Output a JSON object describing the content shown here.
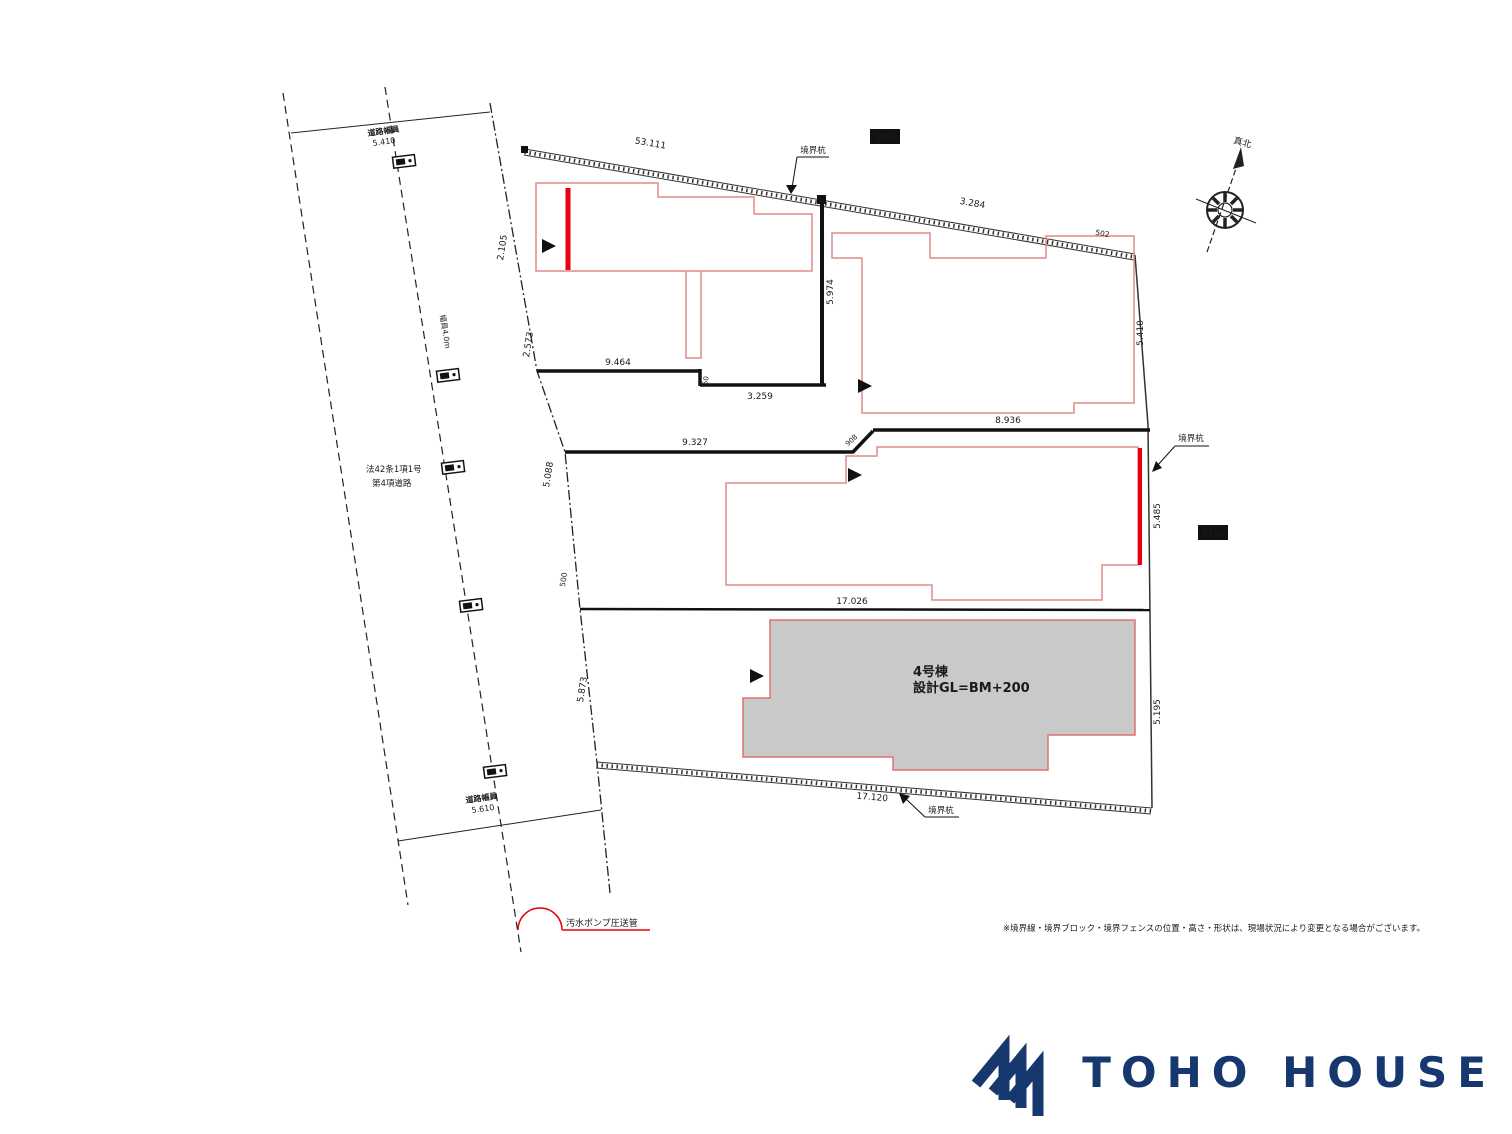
{
  "plan": {
    "north_label": "真北",
    "marker_top": "境界杭",
    "marker_right": "境界杭",
    "marker_bottom": "境界杭",
    "box_top": "B50",
    "box_right": "B110",
    "road": {
      "width_top_label": "道路幅員",
      "width_top_value": "5.410",
      "width_bottom_label": "道路幅員",
      "width_bottom_value": "5.610",
      "law_line1": "法42条1項1号",
      "law_line2": "第4項道路",
      "along_label": "幅員4.0m"
    },
    "dims": {
      "top_main": "53.111",
      "top_right1": "3.284",
      "top_right2": "502",
      "east1": "5.410",
      "east2": "5.485",
      "east3": "5.195",
      "west1": "2.105",
      "west2": "2.573",
      "west3": "5.088",
      "west4": "500",
      "west5": "5.873",
      "div1_a": "9.464",
      "div1_step": "50",
      "div1_b": "3.259",
      "lot2_west": "5.974",
      "div2_a": "9.327",
      "div2_step": "908",
      "div2_b": "8.936",
      "div3": "17.026",
      "south": "17.120"
    },
    "lot4_label_line1": "4号棟",
    "lot4_label_line2": "設計GL=BM+200",
    "drain_note": "汚水ポンプ圧送管",
    "disclaimer": "※境界線・境界ブロック・境界フェンスの位置・高さ・形状は、現場状況により変更となる場合がございます。"
  },
  "footer": {
    "brand": "TOHO HOUSE"
  },
  "colors": {
    "red": "#e60012",
    "pink": "#e08a8a",
    "navy": "#16386e",
    "gray": "#c9c9c9"
  }
}
